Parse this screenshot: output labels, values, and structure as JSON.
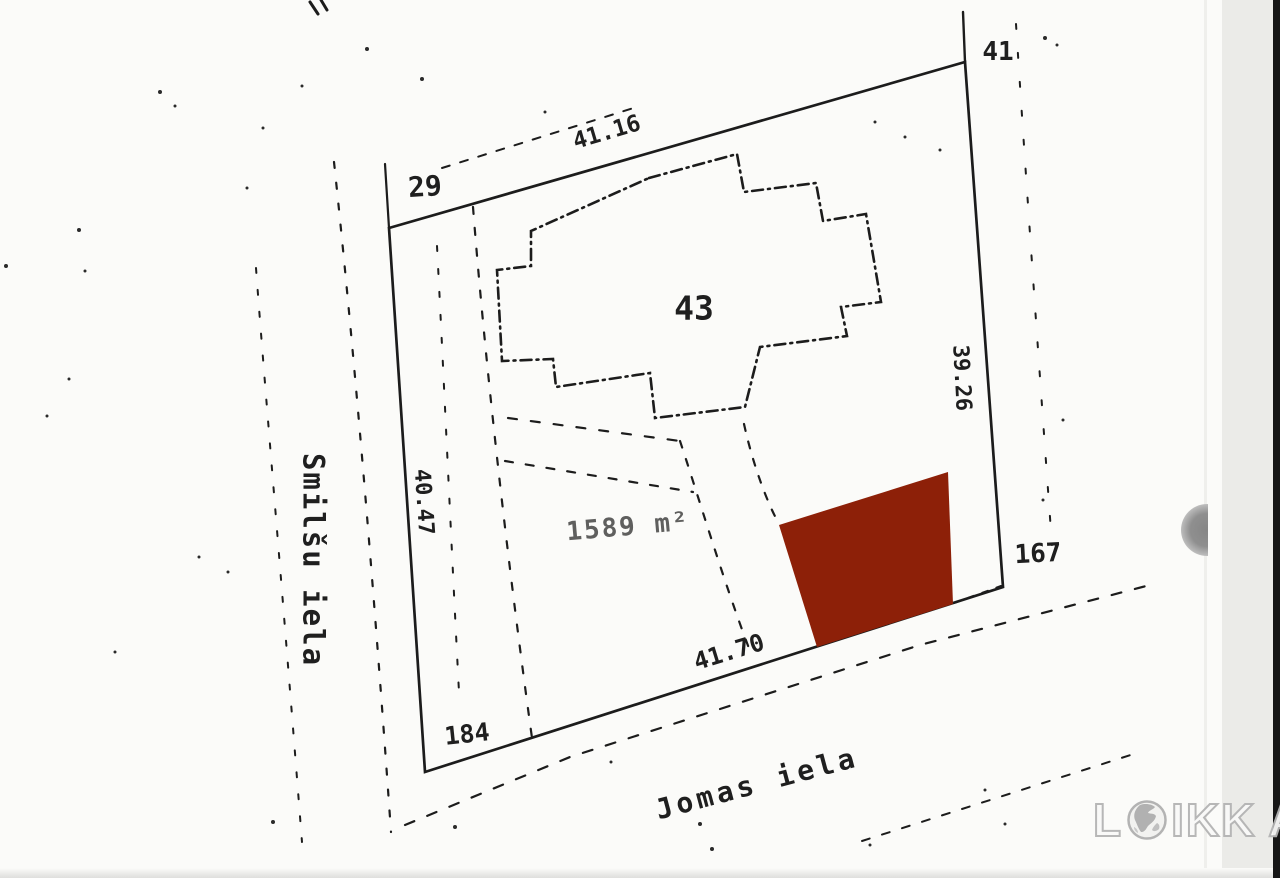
{
  "map": {
    "labels": {
      "corner_top_left": "29",
      "corner_top_right": "41",
      "corner_bottom_right": "167",
      "corner_bottom_left": "184",
      "dim_top": "41.16",
      "dim_right": "39.26",
      "dim_left": "40.47",
      "dim_bottom": "41.70",
      "building_number": "43",
      "plot_area": "1589 m²",
      "street_west": "Smilšu iela",
      "street_south": "Jomas iela"
    },
    "icons": {
      "globe": "globe-icon"
    },
    "colors": {
      "highlight_red": "#8d2008",
      "ink": "#1c1c1c",
      "paper": "#fbfbf9"
    }
  },
  "watermark": {
    "left_letter": "L",
    "middle_letters": "IKK",
    "right_letter": "A"
  }
}
